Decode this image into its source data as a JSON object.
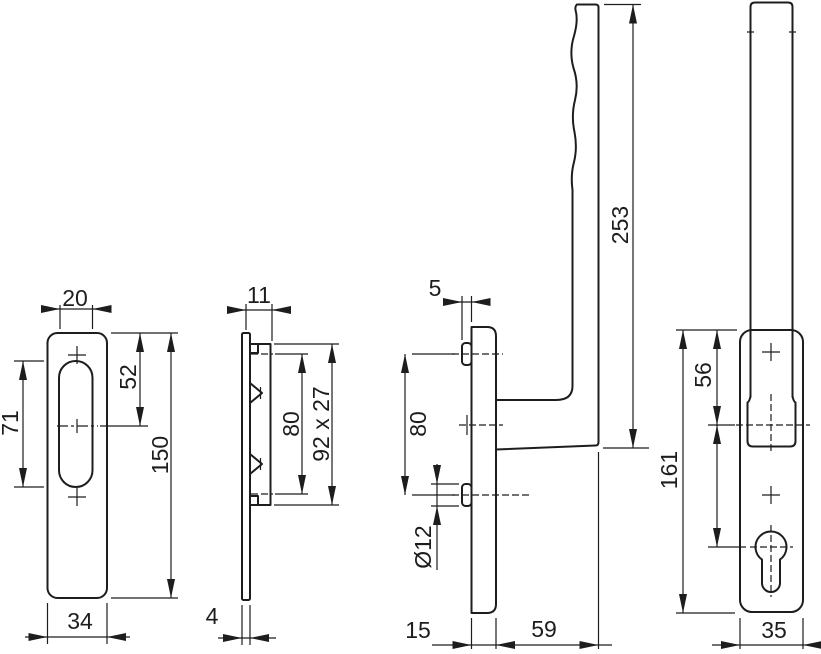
{
  "drawing": {
    "title": "lift-slide handle set technical drawing",
    "colors": {
      "line": "#1d1d1b",
      "background": "#ffffff"
    },
    "views": {
      "backplate_front": {
        "dims": {
          "slot_width": "20",
          "top_to_center": "52",
          "slot_length": "71",
          "plate_length": "150",
          "plate_width": "34"
        }
      },
      "backplate_side": {
        "dims": {
          "total_depth": "11",
          "hole_spacing": "80",
          "pad_size": "92 x 27",
          "plate_thickness": "4"
        }
      },
      "handle_side": {
        "dims": {
          "boss_height": "5",
          "hole_spacing": "80",
          "boss_diameter": "Ø12",
          "grip_length": "253",
          "plate_depth": "15",
          "grip_offset": "59"
        }
      },
      "handle_front": {
        "dims": {
          "top_to_axis": "56",
          "plate_length": "161",
          "plate_width": "35"
        }
      }
    }
  }
}
